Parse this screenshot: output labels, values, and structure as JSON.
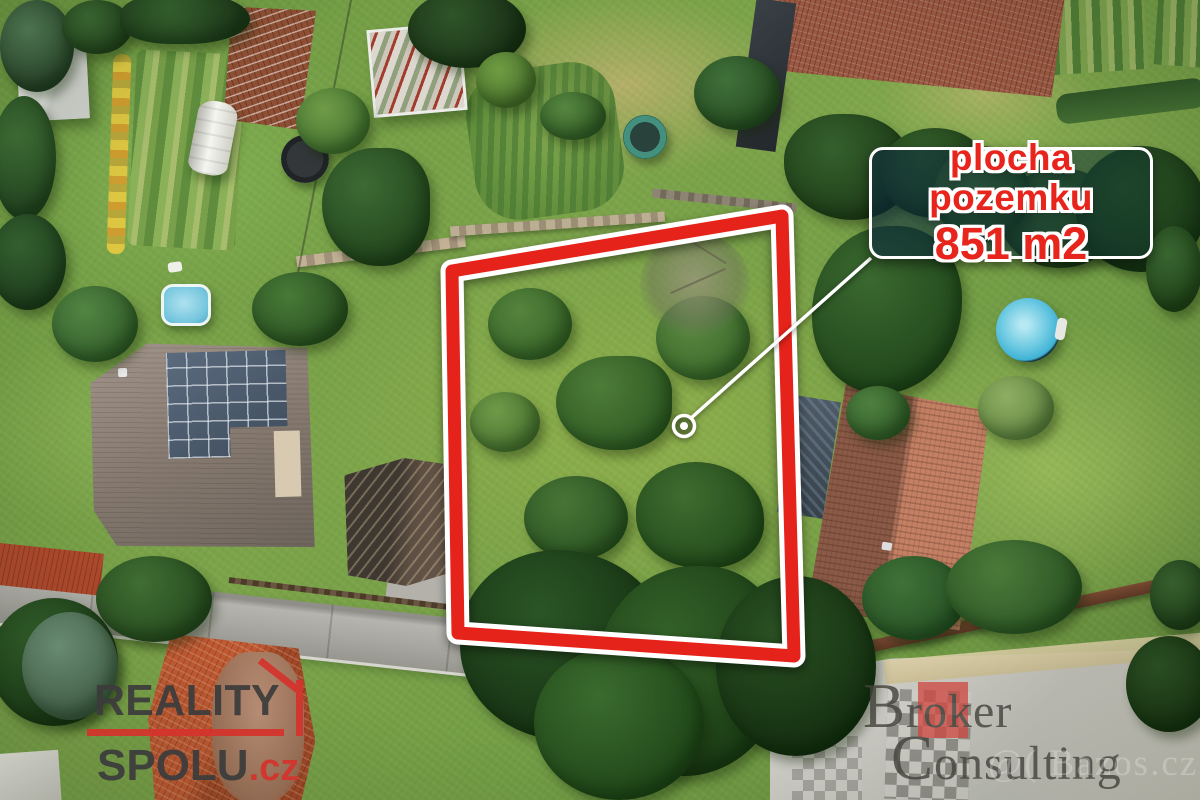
{
  "annotation": {
    "area_label_line1": "plocha pozemku",
    "area_label_line2": "851 m2"
  },
  "branding": {
    "agency_name_top": "REALITY",
    "agency_name_bottom": "SPOLU",
    "agency_tld": ".cz",
    "partner_name_top": "Broker",
    "partner_name_bottom": "Consulting",
    "photo_watermark_prefix": "@(",
    "photo_watermark": "Bazos.cz"
  },
  "colors": {
    "boundary_red": "#e6231a",
    "label_text_red": "#e8251d",
    "agency_red": "#d5332c",
    "partner_red": "#cf4740",
    "callout_white": "#ffffff"
  }
}
